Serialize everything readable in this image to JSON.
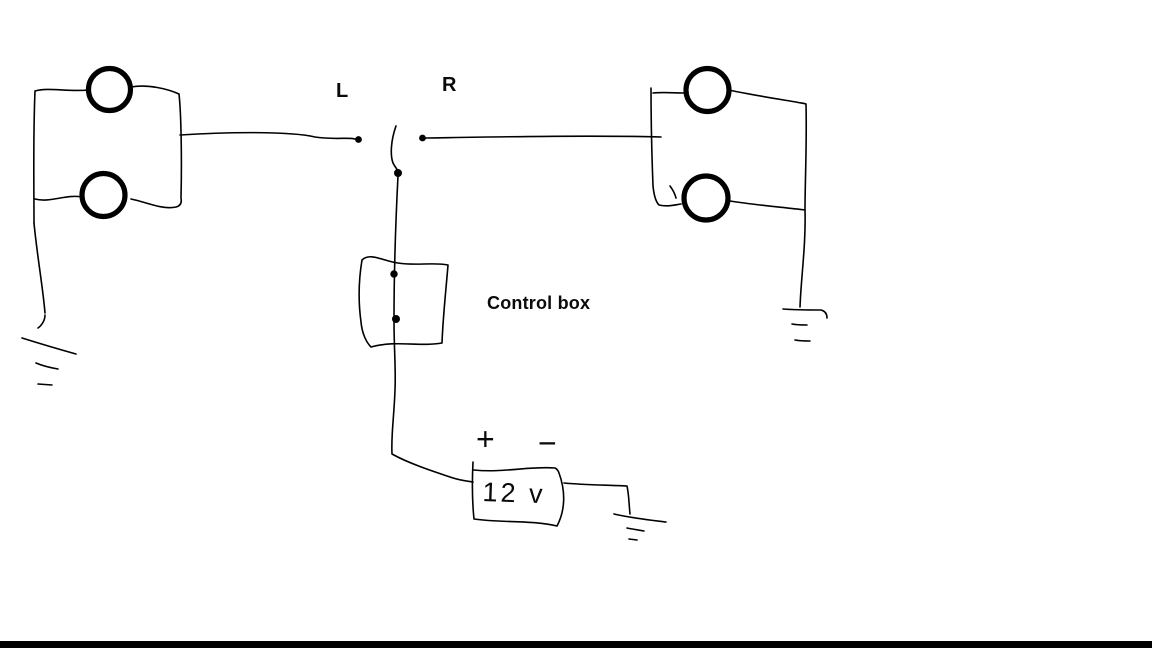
{
  "diagram": {
    "labels": {
      "left": "L",
      "right": "R",
      "control_box": "Control box",
      "battery_plus": "+",
      "battery_minus": "−",
      "battery_voltage": "12 v"
    },
    "components": {
      "left_lamps": "two indicator lamps wired in a loop, grounded bottom-left",
      "right_lamps": "two indicator lamps wired in a loop, grounded bottom-right",
      "switch": "center toggle lever between L and R contact dots",
      "control_box": "hand-drawn box with two terminal dots on the switch wire",
      "battery": "hand-drawn 12 v battery box with + and − terminals, negative side grounded"
    },
    "colors": {
      "ink": "#000000",
      "background": "#ffffff",
      "bottom_bar": "#000000"
    }
  }
}
